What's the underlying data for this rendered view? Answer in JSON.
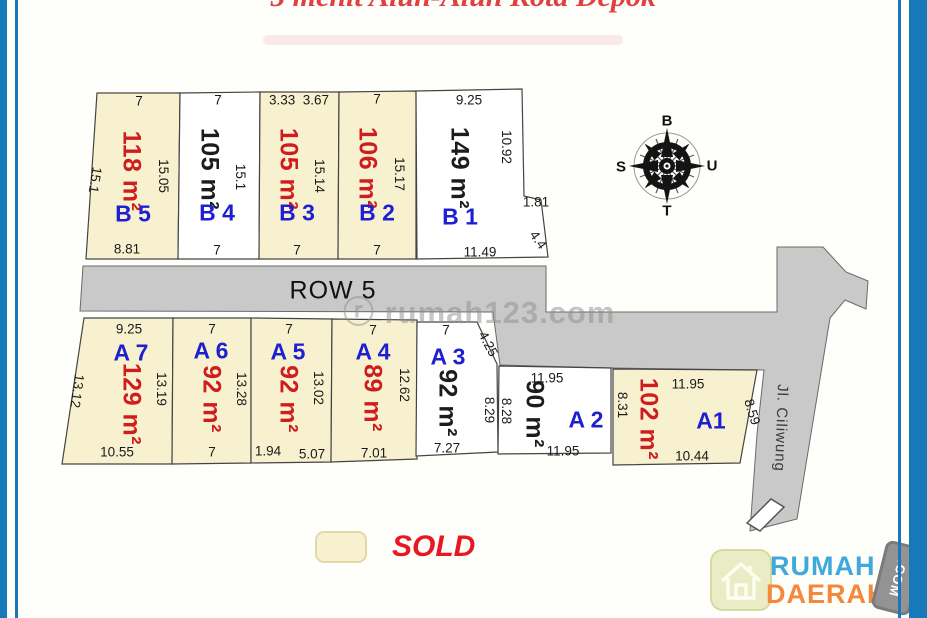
{
  "title": "5 menit Alun-Alun Kota Depok",
  "watermark": "ⓡ rumah123.com",
  "road": {
    "row_label": "ROW 5",
    "street_label": "Jl. Ciliwung"
  },
  "compass": {
    "top": "B",
    "right": "U",
    "bottom": "T",
    "left": "S"
  },
  "legend": {
    "sold_label": "SOLD"
  },
  "logo": {
    "word1": "RUMAH",
    "word2": "DAERAH",
    "tag": ".COM"
  },
  "colors": {
    "sold_fill": "#f8f1d0",
    "available_fill": "#ffffff",
    "road_fill": "#c9c9c9",
    "label_blue": "#1f1fd2",
    "area_red": "#cf1d1d",
    "frame_blue": "#1779b8",
    "title_red": "#e04040"
  },
  "plots": {
    "b5": {
      "label": "B 5",
      "area": "118 m²",
      "status": "sold",
      "dim_top": "7",
      "dim_left": "15.1",
      "dim_right": "15.05",
      "dim_bottom": "8.81"
    },
    "b4": {
      "label": "B 4",
      "area": "105 m²",
      "status": "available",
      "dim_top": "7",
      "dim_right": "15.1",
      "dim_bottom": "7"
    },
    "b3": {
      "label": "B 3",
      "area": "105 m²",
      "status": "sold",
      "dim_top": "3.33  3.67",
      "dim_right": "15.14",
      "dim_bottom": "7"
    },
    "b2": {
      "label": "B 2",
      "area": "106 m²",
      "status": "sold",
      "dim_top": "7",
      "dim_right": "15.17",
      "dim_bottom": "7"
    },
    "b1": {
      "label": "B 1",
      "area": "149 m²",
      "status": "available",
      "dim_top": "9.25",
      "dim_right": "10.92",
      "dim_step": "1.81",
      "dim_diag": "4.4",
      "dim_bottom": "11.49"
    },
    "a7": {
      "label": "A 7",
      "area": "129 m²",
      "status": "sold",
      "dim_top": "9.25",
      "dim_left": "13.12",
      "dim_right": "13.19",
      "dim_bottom": "10.55"
    },
    "a6": {
      "label": "A 6",
      "area": "92 m²",
      "status": "sold",
      "dim_top": "7",
      "dim_right": "13.28",
      "dim_bottom": "7"
    },
    "a5": {
      "label": "A 5",
      "area": "92 m²",
      "status": "sold",
      "dim_top": "7",
      "dim_right": "13.02",
      "dim_bottom_left": "1.94",
      "dim_bottom": "5.07"
    },
    "a4": {
      "label": "A 4",
      "area": "89 m²",
      "status": "sold",
      "dim_top": "7",
      "dim_right": "12.62",
      "dim_bottom": "7.01"
    },
    "a3": {
      "label": "A 3",
      "area": "92 m²",
      "status": "available",
      "dim_top": "7",
      "dim_diag": "4.25",
      "dim_right": "8.29",
      "dim_bottom": "7.27"
    },
    "a2": {
      "label": "A 2",
      "area": "90 m²",
      "status": "available",
      "dim_top": "11.95",
      "dim_left": "8.28",
      "dim_bottom": "11.95"
    },
    "a1": {
      "label": "A1",
      "area": "102 m²",
      "status": "sold",
      "dim_top": "11.95",
      "dim_left": "8.31",
      "dim_right": "8.59",
      "dim_bottom": "10.44"
    }
  }
}
